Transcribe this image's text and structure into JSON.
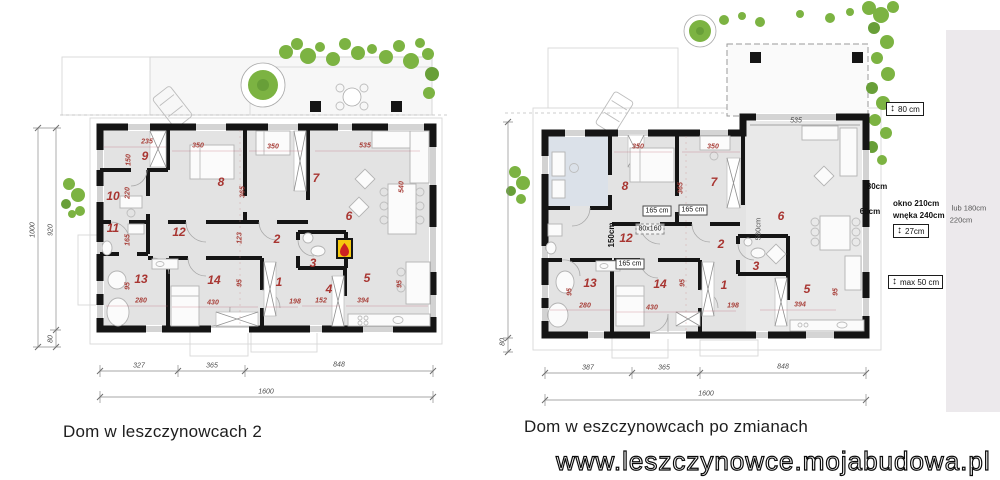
{
  "captions": {
    "left": "Dom w leszczynowcach 2",
    "right": "Dom w eszczynowcach po zmianach"
  },
  "watermark": "www.leszczynowce.mojabudowa.pl",
  "left_plan": {
    "title": "Dom w leszczynowcach 2",
    "labels": [
      {
        "t": "9",
        "x": 145,
        "y": 156,
        "c": "room"
      },
      {
        "t": "8",
        "x": 221,
        "y": 182,
        "c": "room"
      },
      {
        "t": "7",
        "x": 316,
        "y": 178,
        "c": "room"
      },
      {
        "t": "6",
        "x": 349,
        "y": 216,
        "c": "room"
      },
      {
        "t": "10",
        "x": 113,
        "y": 196,
        "c": "room"
      },
      {
        "t": "11",
        "x": 113,
        "y": 228,
        "c": "room"
      },
      {
        "t": "12",
        "x": 179,
        "y": 232,
        "c": "room"
      },
      {
        "t": "2",
        "x": 277,
        "y": 239,
        "c": "room"
      },
      {
        "t": "3",
        "x": 313,
        "y": 263,
        "c": "room"
      },
      {
        "t": "1",
        "x": 279,
        "y": 282,
        "c": "room"
      },
      {
        "t": "4",
        "x": 329,
        "y": 289,
        "c": "room"
      },
      {
        "t": "5",
        "x": 367,
        "y": 278,
        "c": "room"
      },
      {
        "t": "13",
        "x": 141,
        "y": 279,
        "c": "room"
      },
      {
        "t": "14",
        "x": 214,
        "y": 280,
        "c": "room"
      },
      {
        "t": "235",
        "x": 147,
        "y": 142,
        "c": "dim"
      },
      {
        "t": "350",
        "x": 198,
        "y": 146,
        "c": "dim"
      },
      {
        "t": "350",
        "x": 273,
        "y": 147,
        "c": "dim"
      },
      {
        "t": "535",
        "x": 365,
        "y": 146,
        "c": "dim"
      },
      {
        "t": "150",
        "x": 129,
        "y": 160,
        "c": "dim",
        "r": 1
      },
      {
        "t": "220",
        "x": 128,
        "y": 193,
        "c": "dim",
        "r": 1
      },
      {
        "t": "365",
        "x": 243,
        "y": 192,
        "c": "dim",
        "r": 1
      },
      {
        "t": "540",
        "x": 402,
        "y": 187,
        "c": "dim",
        "r": 1
      },
      {
        "t": "165",
        "x": 128,
        "y": 240,
        "c": "dim",
        "r": 1
      },
      {
        "t": "95",
        "x": 128,
        "y": 286,
        "c": "dim",
        "r": 1
      },
      {
        "t": "123",
        "x": 240,
        "y": 238,
        "c": "dim",
        "r": 1
      },
      {
        "t": "95",
        "x": 240,
        "y": 283,
        "c": "dim",
        "r": 1
      },
      {
        "t": "95",
        "x": 400,
        "y": 284,
        "c": "dim",
        "r": 1
      },
      {
        "t": "280",
        "x": 141,
        "y": 301,
        "c": "dim"
      },
      {
        "t": "430",
        "x": 213,
        "y": 303,
        "c": "dim"
      },
      {
        "t": "198",
        "x": 295,
        "y": 302,
        "c": "dim"
      },
      {
        "t": "152",
        "x": 321,
        "y": 301,
        "c": "dim"
      },
      {
        "t": "394",
        "x": 363,
        "y": 301,
        "c": "dim"
      },
      {
        "t": "327",
        "x": 139,
        "y": 366,
        "c": "dimk"
      },
      {
        "t": "365",
        "x": 212,
        "y": 366,
        "c": "dimk"
      },
      {
        "t": "848",
        "x": 339,
        "y": 365,
        "c": "dimk"
      },
      {
        "t": "1600",
        "x": 266,
        "y": 392,
        "c": "dimk"
      },
      {
        "t": "1000",
        "x": 33,
        "y": 230,
        "c": "dimk",
        "r": 1
      },
      {
        "t": "920",
        "x": 51,
        "y": 230,
        "c": "dimk",
        "r": 1
      },
      {
        "t": "80",
        "x": 51,
        "y": 339,
        "c": "dimk",
        "r": 1
      }
    ]
  },
  "right_plan": {
    "title": "Dom w eszczynowcach po zmianach",
    "labels": [
      {
        "t": "8",
        "x": 625,
        "y": 186,
        "c": "room"
      },
      {
        "t": "7",
        "x": 714,
        "y": 182,
        "c": "room"
      },
      {
        "t": "6",
        "x": 781,
        "y": 216,
        "c": "room"
      },
      {
        "t": "2",
        "x": 721,
        "y": 244,
        "c": "room"
      },
      {
        "t": "12",
        "x": 626,
        "y": 238,
        "c": "room"
      },
      {
        "t": "13",
        "x": 590,
        "y": 283,
        "c": "room"
      },
      {
        "t": "14",
        "x": 660,
        "y": 284,
        "c": "room"
      },
      {
        "t": "1",
        "x": 724,
        "y": 285,
        "c": "room"
      },
      {
        "t": "3",
        "x": 756,
        "y": 266,
        "c": "room"
      },
      {
        "t": "5",
        "x": 807,
        "y": 289,
        "c": "room"
      },
      {
        "t": "350",
        "x": 638,
        "y": 147,
        "c": "dim"
      },
      {
        "t": "350",
        "x": 713,
        "y": 147,
        "c": "dim"
      },
      {
        "t": "365",
        "x": 681,
        "y": 188,
        "c": "dim",
        "r": 1
      },
      {
        "t": "95",
        "x": 570,
        "y": 292,
        "c": "dim",
        "r": 1
      },
      {
        "t": "95",
        "x": 683,
        "y": 283,
        "c": "dim",
        "r": 1
      },
      {
        "t": "95",
        "x": 836,
        "y": 292,
        "c": "dim",
        "r": 1
      },
      {
        "t": "280",
        "x": 585,
        "y": 306,
        "c": "dim"
      },
      {
        "t": "430",
        "x": 652,
        "y": 308,
        "c": "dim"
      },
      {
        "t": "198",
        "x": 733,
        "y": 306,
        "c": "dim"
      },
      {
        "t": "394",
        "x": 800,
        "y": 305,
        "c": "dim"
      },
      {
        "t": "165 cm",
        "x": 657,
        "y": 211,
        "c": "boxed"
      },
      {
        "t": "165 cm",
        "x": 693,
        "y": 210,
        "c": "boxed"
      },
      {
        "t": "165 cm",
        "x": 630,
        "y": 264,
        "c": "boxed"
      },
      {
        "t": "80x160",
        "x": 650,
        "y": 229,
        "c": "dboxed"
      },
      {
        "t": "150cm",
        "x": 612,
        "y": 235,
        "c": "annb",
        "r": 1
      },
      {
        "t": "580cm",
        "x": 758,
        "y": 229,
        "c": "annp",
        "r": 1
      },
      {
        "t": "535",
        "x": 796,
        "y": 121,
        "c": "dimk"
      },
      {
        "t": "387",
        "x": 588,
        "y": 368,
        "c": "dimk"
      },
      {
        "t": "365",
        "x": 664,
        "y": 368,
        "c": "dimk"
      },
      {
        "t": "848",
        "x": 783,
        "y": 367,
        "c": "dimk"
      },
      {
        "t": "1600",
        "x": 706,
        "y": 394,
        "c": "dimk"
      },
      {
        "t": "80",
        "x": 503,
        "y": 342,
        "c": "dimk",
        "r": 1
      },
      {
        "t": "80cm",
        "x": 877,
        "y": 187,
        "c": "annb"
      },
      {
        "t": "60cm",
        "x": 870,
        "y": 212,
        "c": "annb"
      },
      {
        "t": "lub 180cm",
        "x": 969,
        "y": 208,
        "c": "annp"
      },
      {
        "t": "220cm",
        "x": 961,
        "y": 220,
        "c": "annp"
      }
    ],
    "arrow_boxes": [
      {
        "label": "80 cm"
      },
      {
        "label": "27cm"
      },
      {
        "label": "max 50 cm"
      }
    ],
    "window_note": {
      "line1": "okno 210cm",
      "line2": "wnęka 240cm"
    }
  }
}
